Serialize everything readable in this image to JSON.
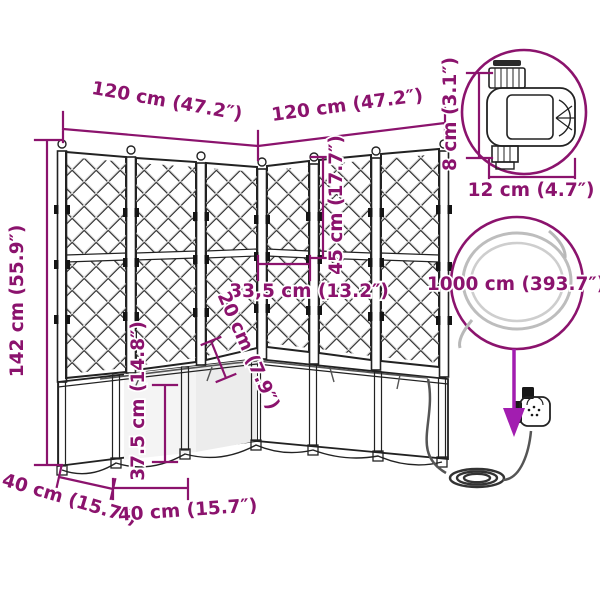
{
  "diagram": {
    "type": "product-dimension-diagram",
    "subject": "corner garden planter with trellis and irrigation set",
    "colors": {
      "dimension": "#8b136d",
      "arrow": "#a21db0",
      "drawing": "#222222",
      "background": "#ffffff"
    },
    "dims": {
      "width_left_wing": "120 cm (47.2″)",
      "width_right_wing": "120 cm (47.2″)",
      "total_height": "142 cm (55.9″)",
      "timer_height": "8 cm (3.1″)",
      "timer_width": "12 cm (4.7″)",
      "upper_trellis_height": "45 cm (17.7″)",
      "lattice_spacing": "33,5 cm (13.2″)",
      "post_exposed_height": "20 cm (7.9″)",
      "box_height": "37.5 cm (14.8″)",
      "left_depth": "40 cm (15.7″)",
      "front_width": "40 cm (15.7″)",
      "hose_length": "1000 cm (393.7″)"
    },
    "icons": {
      "timer_magnifier": "water-timer-illustration",
      "hose_magnifier": "hose-coil-illustration",
      "pointer": "down-arrow"
    }
  }
}
